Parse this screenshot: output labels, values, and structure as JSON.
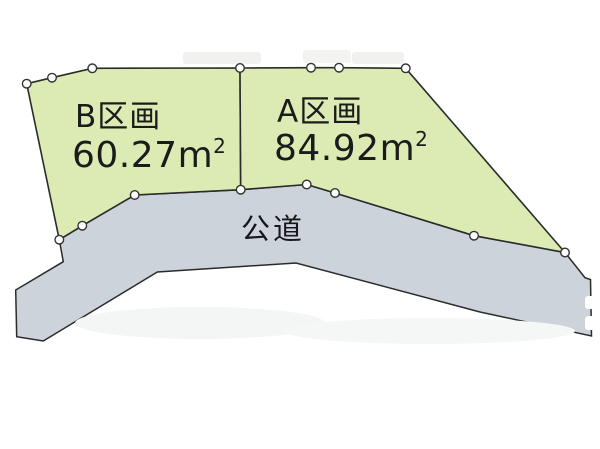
{
  "diagram": {
    "background": "#ffffff",
    "colors": {
      "parcel_fill": "#dcebb4",
      "parcel_stroke": "#2b2b2b",
      "road_fill": "#ccd3da",
      "road_stroke": "#2b2b2b",
      "marker_fill": "#ffffff",
      "marker_stroke": "#333333",
      "text": "#1b1b1b"
    },
    "parcels": [
      {
        "id": "parcel-b",
        "name": "B区画",
        "area_value": "60.27",
        "area_unit": "m",
        "area_unit_sup": "2",
        "points": [
          [
            26.7,
            83.7
          ],
          [
            52,
            77.7
          ],
          [
            92.3,
            68.3
          ],
          [
            240,
            68
          ],
          [
            240.7,
            189.7
          ],
          [
            134.7,
            195
          ],
          [
            82.3,
            225.7
          ],
          [
            59.3,
            239.7
          ]
        ]
      },
      {
        "id": "parcel-a",
        "name": "A区画",
        "area_value": "84.92",
        "area_unit": "m",
        "area_unit_sup": "2",
        "points": [
          [
            240,
            68
          ],
          [
            311,
            67.7
          ],
          [
            339,
            67.7
          ],
          [
            405.7,
            68.3
          ],
          [
            565,
            252.5
          ],
          [
            474,
            235.7
          ],
          [
            335,
            193
          ],
          [
            306.7,
            184.5
          ],
          [
            240.7,
            189.7
          ]
        ]
      }
    ],
    "road": {
      "name": "公道",
      "points": [
        [
          59.3,
          239.7
        ],
        [
          82.3,
          225.7
        ],
        [
          134.7,
          195
        ],
        [
          240.7,
          189.7
        ],
        [
          306.7,
          184.5
        ],
        [
          335,
          193
        ],
        [
          474,
          235.7
        ],
        [
          565,
          252.5
        ],
        [
          585,
          277.7
        ],
        [
          590.5,
          279.5
        ],
        [
          591.5,
          336
        ],
        [
          480,
          312
        ],
        [
          296,
          263
        ],
        [
          157.3,
          272
        ],
        [
          43.3,
          341
        ],
        [
          16.7,
          336.7
        ],
        [
          15.7,
          290
        ],
        [
          63.3,
          261.7
        ]
      ]
    },
    "markers": [
      [
        26.7,
        83.7
      ],
      [
        52,
        77.7
      ],
      [
        92.3,
        68.3
      ],
      [
        240,
        68
      ],
      [
        311,
        67.7
      ],
      [
        339,
        67.7
      ],
      [
        405.7,
        68.3
      ],
      [
        59.3,
        239.7
      ],
      [
        82.3,
        225.7
      ],
      [
        134.7,
        195
      ],
      [
        240.7,
        189.7
      ],
      [
        306.7,
        184.5
      ],
      [
        335,
        193
      ],
      [
        474,
        235.7
      ],
      [
        565,
        252.5
      ]
    ],
    "smudges": [
      {
        "type": "rect",
        "x": 183,
        "y": 52,
        "w": 78,
        "h": 12,
        "fill": "#f1f2f0"
      },
      {
        "type": "rect",
        "x": 303,
        "y": 50,
        "w": 48,
        "h": 13,
        "fill": "#f3f3f1"
      },
      {
        "type": "rect",
        "x": 352,
        "y": 52,
        "w": 52,
        "h": 12,
        "fill": "#f1f2f0"
      },
      {
        "type": "rect",
        "x": 585,
        "y": 296,
        "w": 16,
        "h": 13,
        "fill": "#ffffff"
      },
      {
        "type": "rect",
        "x": 585,
        "y": 316,
        "w": 16,
        "h": 14,
        "fill": "#ffffff"
      },
      {
        "type": "ellipse",
        "cx": 200,
        "cy": 323,
        "rx": 125,
        "ry": 16,
        "fill": "#f4f5f5"
      },
      {
        "type": "ellipse",
        "cx": 430,
        "cy": 331,
        "rx": 145,
        "ry": 13,
        "fill": "#f5f6f6"
      }
    ]
  }
}
